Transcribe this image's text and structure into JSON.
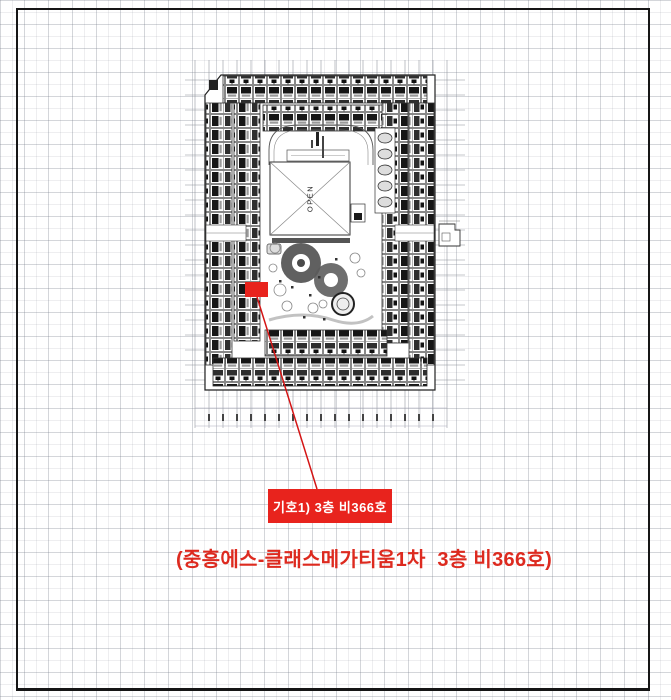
{
  "document": {
    "type": "floor-plan annotation page",
    "frame_color": "#161616",
    "grid_cell_px": 12
  },
  "floor_plan": {
    "open_label": "OPEN"
  },
  "annotation": {
    "highlight_color": "#e8231d",
    "line_color": "#d41414",
    "unit_label": "기호1) 3층 비366호",
    "label_text_color": "#ffffff",
    "caption": "(중흥에스-클래스메가티움1차  3층 비366호)",
    "caption_color": "#dd2a1f"
  }
}
